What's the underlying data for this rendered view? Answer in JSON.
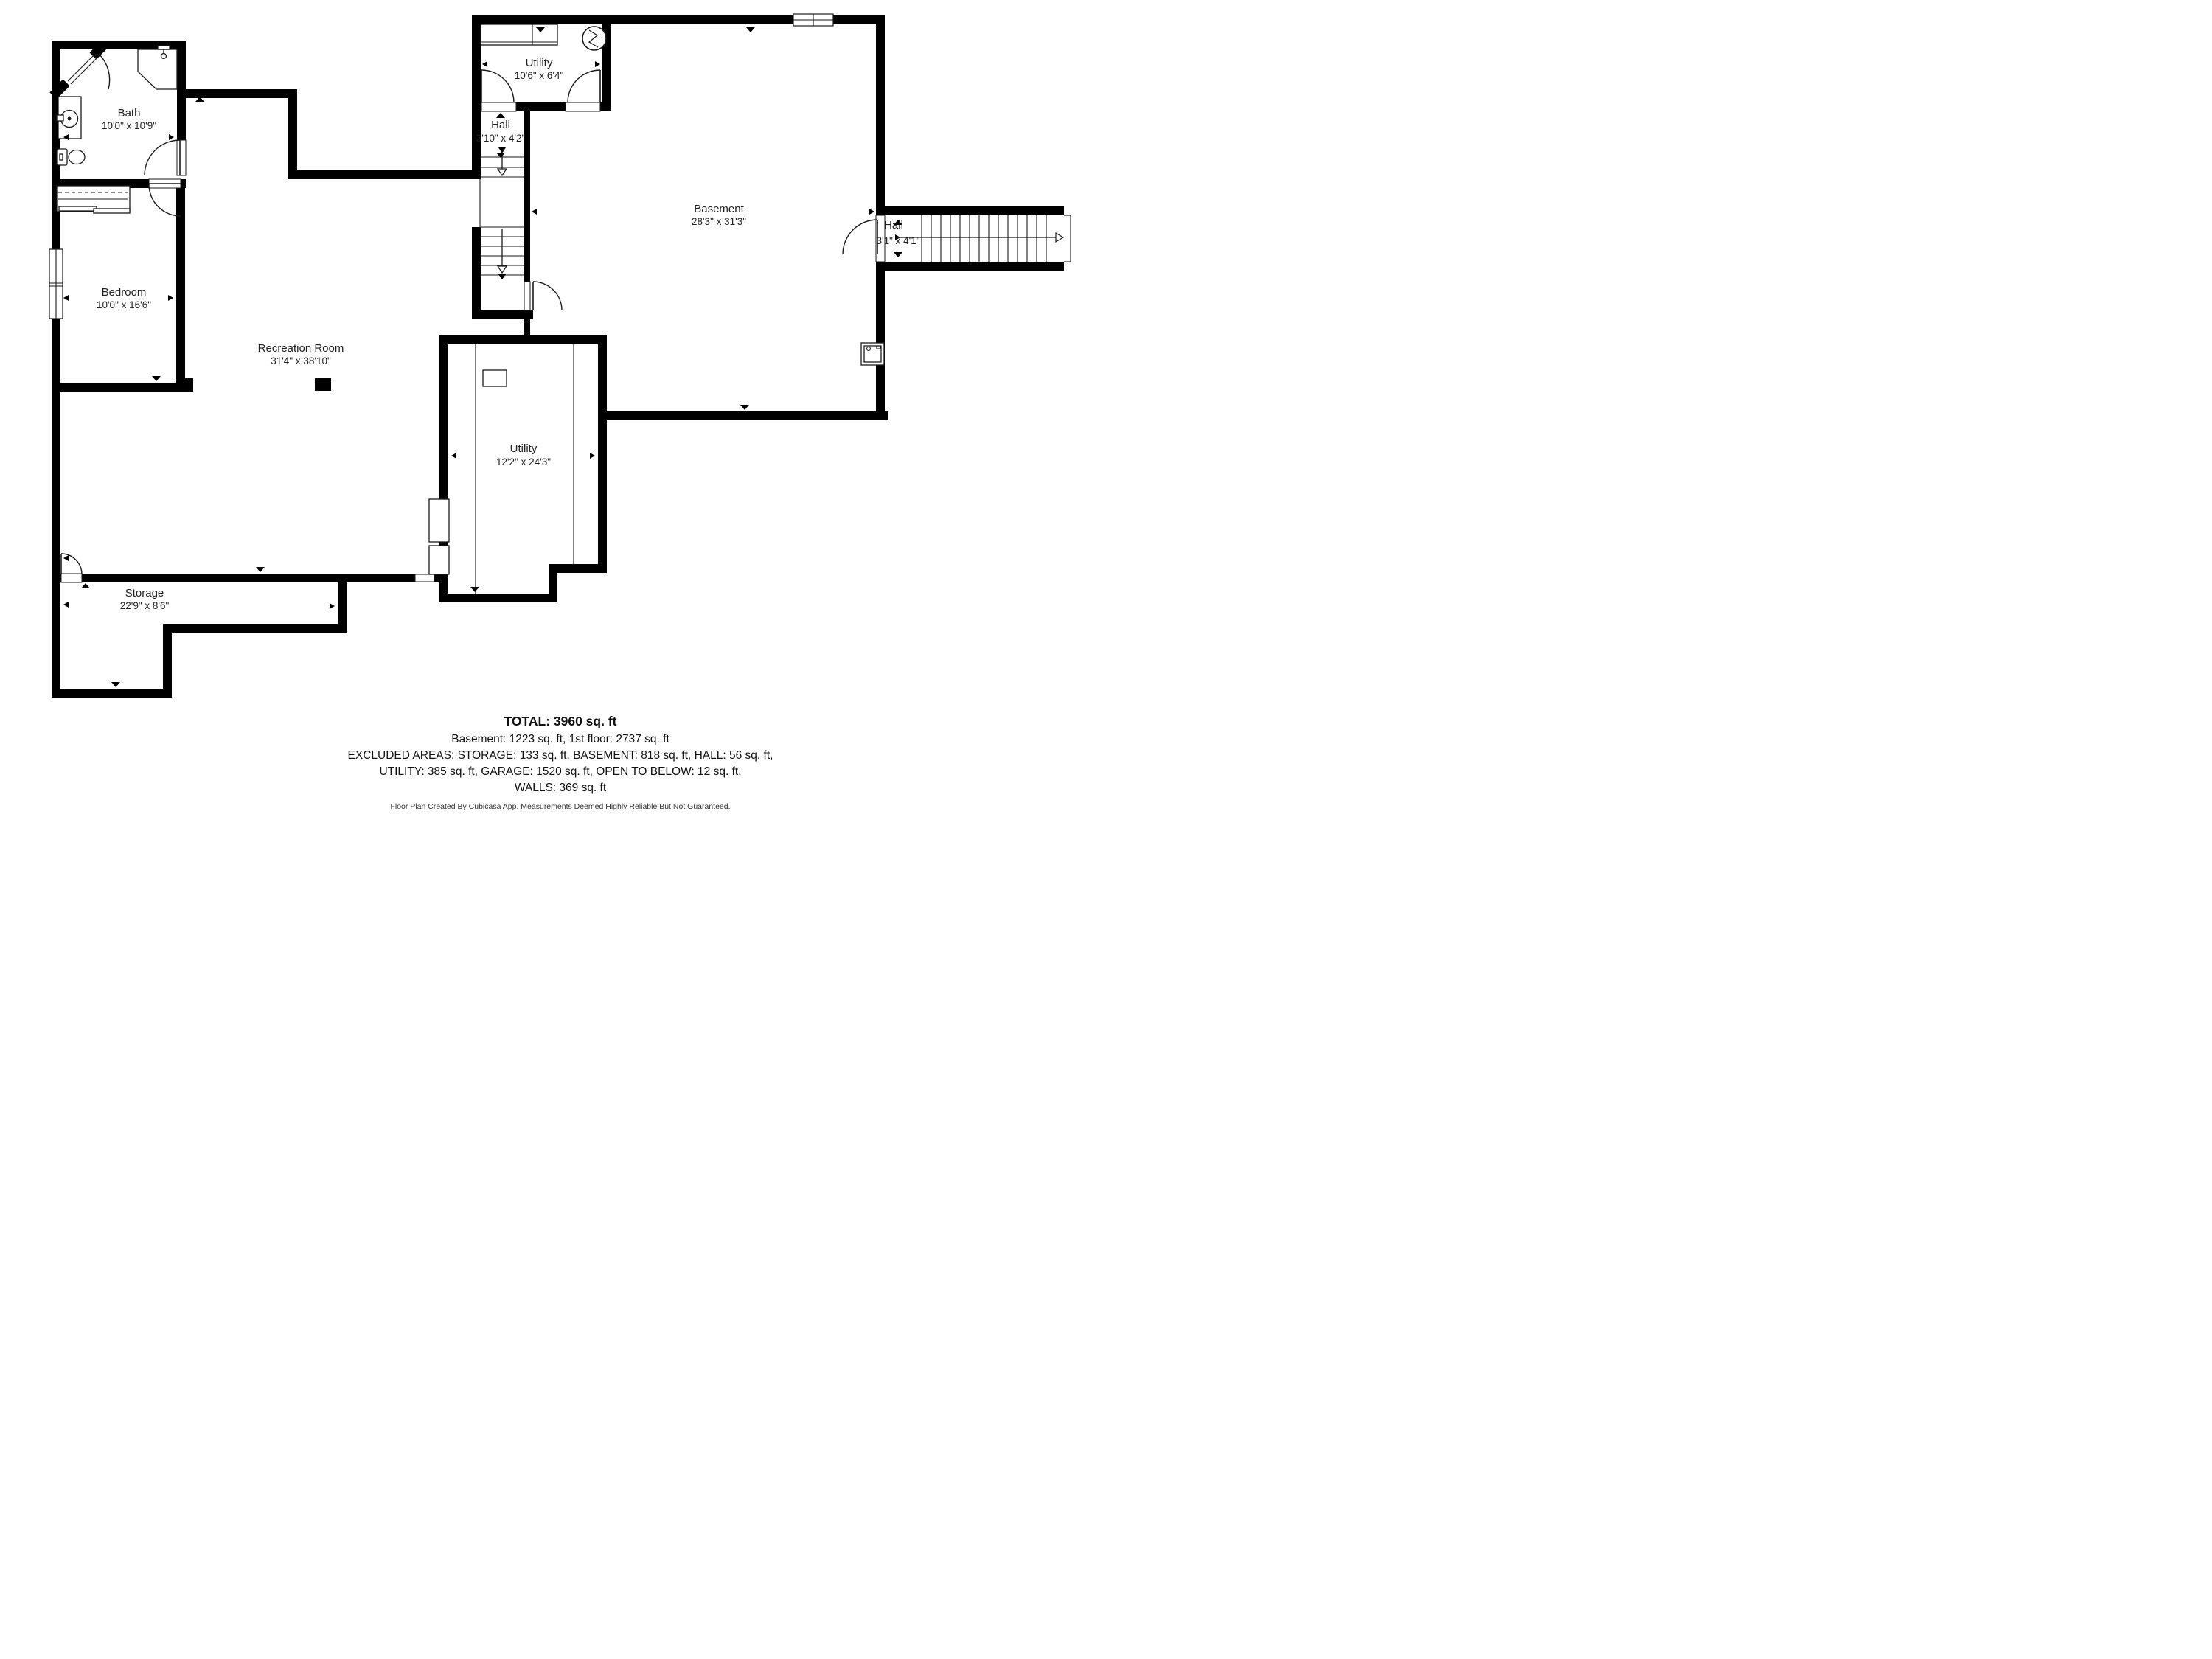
{
  "page": {
    "background": "#ffffff"
  },
  "plan": {
    "colors": {
      "wall": "#000000",
      "line": "#1a1a1a",
      "text": "#1f1f1f"
    },
    "rooms": {
      "bath": {
        "name": "Bath",
        "dims": "10'0\" x 10'9\""
      },
      "utility_top": {
        "name": "Utility",
        "dims": "10'6\" x 6'4\""
      },
      "hall_top": {
        "name": "Hall",
        "dims": "3'10\" x 4'2\""
      },
      "basement": {
        "name": "Basement",
        "dims": "28'3\" x 31'3\""
      },
      "hall_right": {
        "name": "Hall",
        "dims": "3'1\" x 4'1\""
      },
      "bedroom": {
        "name": "Bedroom",
        "dims": "10'0\" x 16'6\""
      },
      "recreation": {
        "name": "Recreation Room",
        "dims": "31'4\" x 38'10\""
      },
      "utility_mid": {
        "name": "Utility",
        "dims": "12'2\" x 24'3\""
      },
      "storage": {
        "name": "Storage",
        "dims": "22'9\" x 8'6\""
      }
    },
    "summary": {
      "total": "TOTAL: 3960 sq. ft",
      "line1": "Basement: 1223 sq. ft, 1st floor: 2737 sq. ft",
      "line2": "EXCLUDED AREAS: STORAGE: 133 sq. ft, BASEMENT: 818 sq. ft, HALL: 56 sq. ft,",
      "line3": "UTILITY: 385 sq. ft, GARAGE: 1520 sq. ft, OPEN TO BELOW: 12 sq. ft,",
      "line4": "WALLS: 369 sq. ft"
    },
    "disclaimer": "Floor Plan Created By Cubicasa App. Measurements Deemed Highly Reliable But Not Guaranteed."
  }
}
